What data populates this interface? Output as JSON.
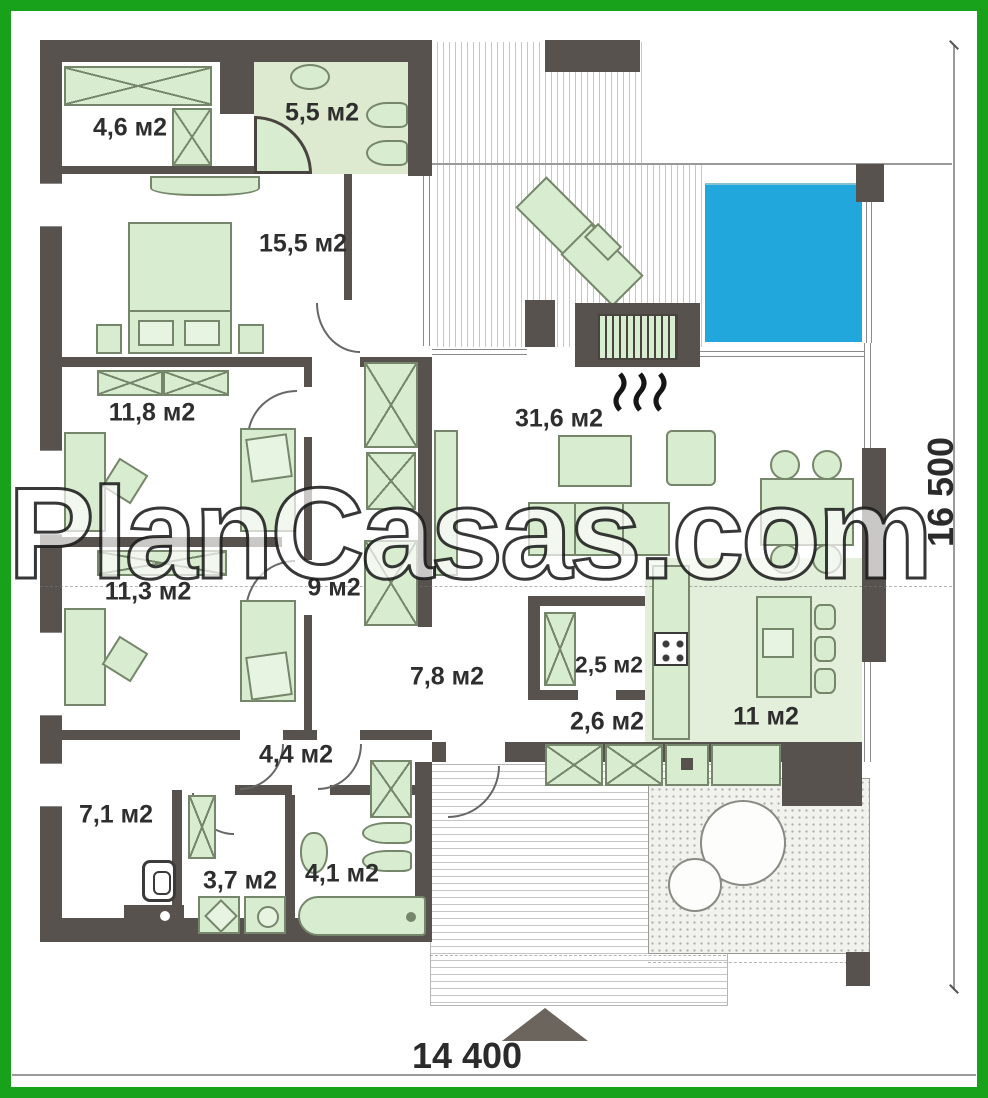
{
  "watermark": {
    "text": "PlanCasas.com"
  },
  "dimensions": {
    "width_label": "14 400",
    "height_label": "16 500"
  },
  "rooms": [
    {
      "id": "wardrobe-top",
      "label": "4,6 м2"
    },
    {
      "id": "bathroom-top",
      "label": "5,5 м2"
    },
    {
      "id": "bedroom",
      "label": "15,5 м2"
    },
    {
      "id": "child-room-1",
      "label": "11,8 м2"
    },
    {
      "id": "child-room-2",
      "label": "11,3 м2"
    },
    {
      "id": "hall-wardrobe",
      "label": "9 м2"
    },
    {
      "id": "living-room",
      "label": "31,6 м2"
    },
    {
      "id": "pantry",
      "label": "2,5 м2"
    },
    {
      "id": "corridor",
      "label": "2,6 м2"
    },
    {
      "id": "kitchen",
      "label": "11 м2"
    },
    {
      "id": "hallway",
      "label": "7,8 м2"
    },
    {
      "id": "utility-room",
      "label": "7,1 м2"
    },
    {
      "id": "entry-hall",
      "label": "4,4 м2"
    },
    {
      "id": "laundry",
      "label": "3,7 м2"
    },
    {
      "id": "bathroom-2",
      "label": "4,1 м2"
    }
  ],
  "colors": {
    "frame_green": "#18a21c",
    "wall": "#57524d",
    "furniture_fill": "#d8ecd0",
    "furniture_line": "#75866b",
    "pool_blue": "#21a7dc",
    "kitchen_floor": "#e3efda",
    "label_text": "#2e2e2e"
  }
}
